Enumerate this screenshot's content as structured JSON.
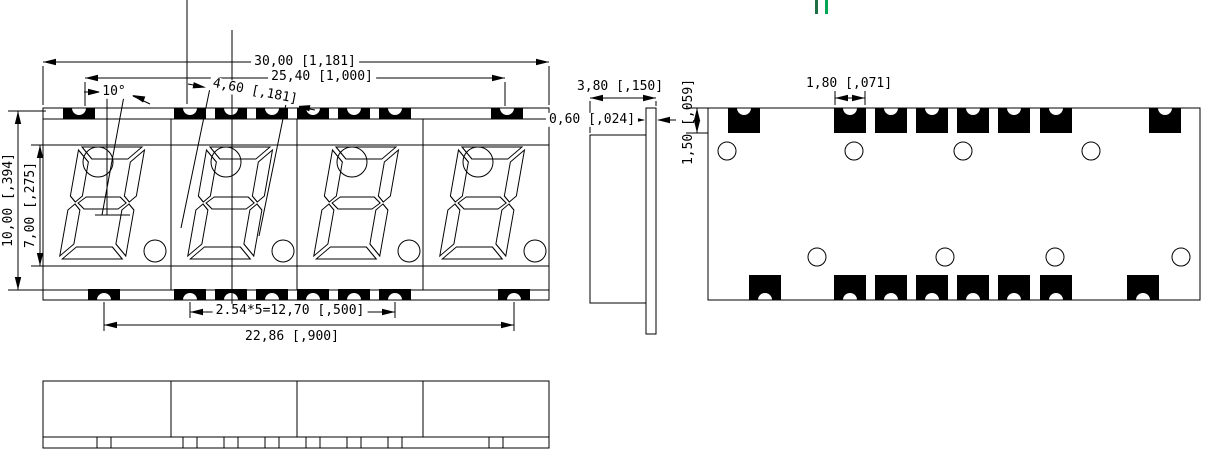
{
  "views": {
    "front": {
      "dims": {
        "total_width": "30,00 [1,181]",
        "pin_span": "25,40 [1,000]",
        "tilt_angle": "10°",
        "char_width": "4,60 [,181]",
        "body_height": "10,00 [,394]",
        "digit_height": "7,00 [,275]",
        "pin_pitch": "2.54*5=12,70 [,500]",
        "pad_row_span": "22,86 [,900]"
      }
    },
    "side": {
      "dims": {
        "depth": "3,80 [,150]",
        "substrate_thickness": "0,60 [,024]"
      }
    },
    "back": {
      "dims": {
        "pad_width": "1,80 [,071]",
        "pad_height": "1,50 [,059]"
      }
    },
    "bottom": {
      "dims": {}
    }
  },
  "colors": {
    "line": "#000000",
    "pad_fill": "#000000",
    "background": "#ffffff",
    "accent_green": "#00a651",
    "accent_green_dark": "#1f6f43"
  }
}
